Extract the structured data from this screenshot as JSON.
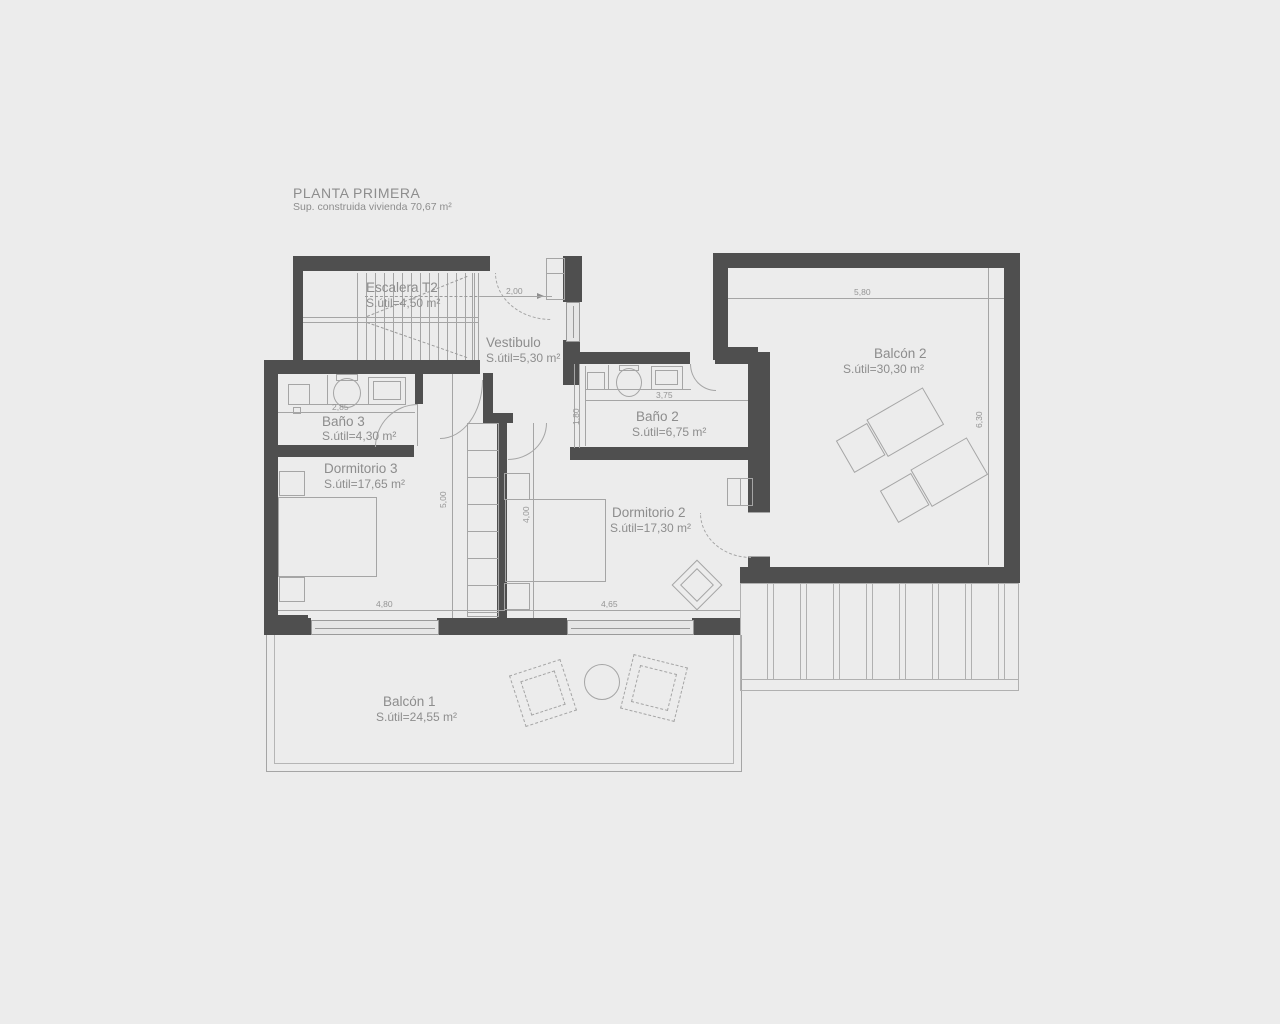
{
  "title": {
    "main": "PLANTA PRIMERA",
    "sub": "Sup. construida vivienda 70,67 m²"
  },
  "rooms": {
    "escalera": {
      "name": "Escalera T2",
      "area": "S.útil=4,50 m²"
    },
    "vestibulo": {
      "name": "Vestibulo",
      "area": "S.útil=5,30 m²"
    },
    "bano3": {
      "name": "Baño 3",
      "area": "S.útil=4,30 m²"
    },
    "dormitorio3": {
      "name": "Dormitorio 3",
      "area": "S.útil=17,65 m²"
    },
    "bano2": {
      "name": "Baño 2",
      "area": "S.útil=6,75 m²"
    },
    "dormitorio2": {
      "name": "Dormitorio 2",
      "area": "S.útil=17,30 m²"
    },
    "balcon2": {
      "name": "Balcón 2",
      "area": "S.útil=30,30 m²"
    },
    "balcon1": {
      "name": "Balcón 1",
      "area": "S.útil=24,55 m²"
    }
  },
  "dims": {
    "vest_w": "2,00",
    "bano3_w": "2,85",
    "bano2_w": "3,75",
    "bano2_d": "1,80",
    "dorm3_d": "5,00",
    "dorm2_d": "4,00",
    "dorm3_w": "4,80",
    "dorm2_w": "4,65",
    "balcon2_w": "5,80",
    "balcon2_d": "6,30"
  },
  "colors": {
    "wall": "#4f4f4f",
    "line": "#a5a5a5",
    "background": "#ececec",
    "text": "#8d8d8d"
  }
}
